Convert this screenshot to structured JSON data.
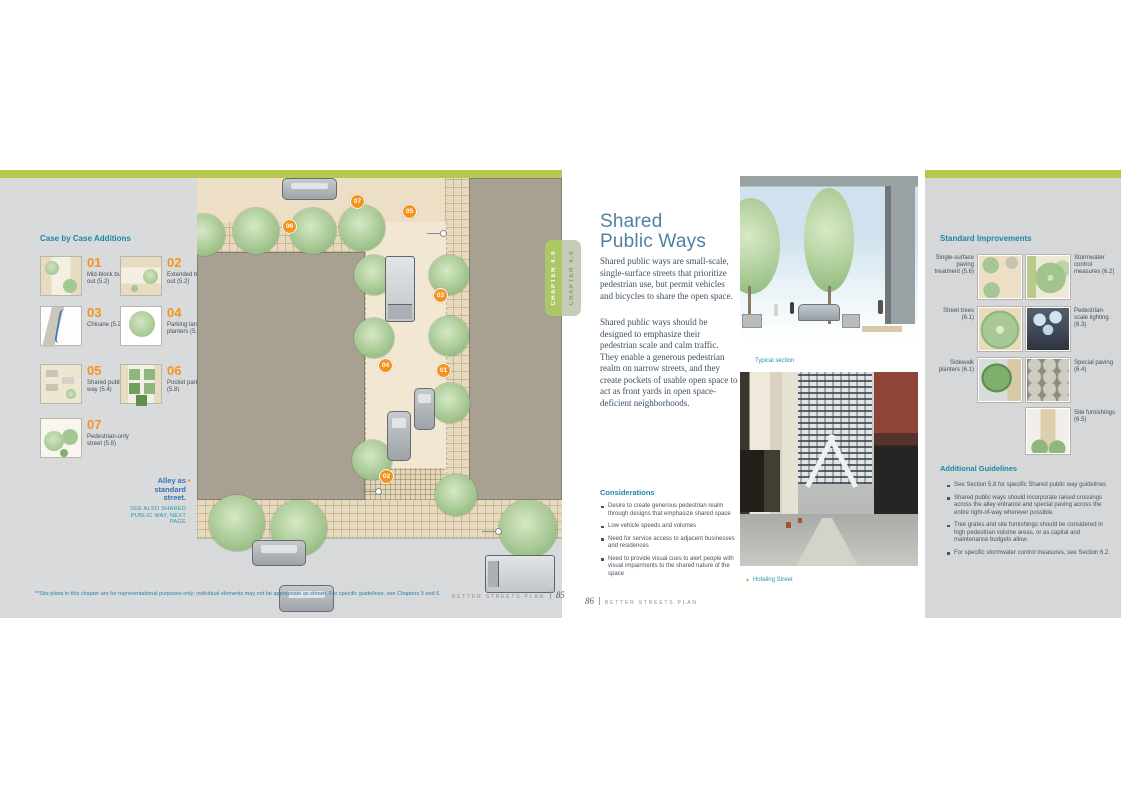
{
  "colors": {
    "accent_green": "#b3c84f",
    "teal_heading": "#1f87a3",
    "orange": "#f6921e",
    "link_blue": "#2f74b5"
  },
  "left_page": {
    "heading": "Case by Case Additions",
    "case_items": [
      {
        "num": "01",
        "label": "Mid-block bulb-out (5.2)"
      },
      {
        "num": "02",
        "label": "Extended bulb-out (5.2)"
      },
      {
        "num": "03",
        "label": "Chicane (5.2)"
      },
      {
        "num": "04",
        "label": "Parking lane planters (5.6)"
      },
      {
        "num": "05",
        "label": "Shared public way (5.4)"
      },
      {
        "num": "06",
        "label": "Pocket park (5.8)"
      },
      {
        "num": "07",
        "label": "Pedestrian-only street (5.8)"
      }
    ],
    "alley_callout_title": "Alley as standard street.",
    "alley_callout_note": "SEE ALSO SHARED PUBLIC WAY, NEXT PAGE",
    "plan_callouts": [
      "07",
      "05",
      "06",
      "03",
      "04",
      "01",
      "02"
    ],
    "footnote": "**Site plans in this chapter are for representational purposes only; individual elements may not be appropriate as shown. For specific guidelines, see Chapters 5 and 6.",
    "footer_book": "BETTER STREETS PLAN",
    "footer_page": "85"
  },
  "chapter_tab": {
    "front": "CHAPTER 4.0",
    "back": "CHAPTER 4.0"
  },
  "right_page": {
    "title_line1": "Shared",
    "title_line2": "Public Ways",
    "intro_p1": "Shared public ways are small-scale, single-surface streets that prioritize pedestrian use, but permit vehicles and bicycles to share the open space.",
    "intro_p2": "Shared public ways should be designed to emphasize their pedestrian scale and calm traffic. They enable a generous pedestrian realm on narrow streets, and they create pockets of usable open space to act as front yards in open space-deficient neighborhoods.",
    "considerations_heading": "Considerations",
    "considerations": [
      "Desire to create generous pedestrian realm through designs that emphasize shared space",
      "Low vehicle speeds and volumes",
      "Need for service access to adjacent businesses and residences",
      "Need to provide visual cues to alert people with visual impairments to the shared nature of the space"
    ],
    "typical_section_caption": "Typical section",
    "photo_caption": "Hotaling Street",
    "footer_page": "86",
    "footer_book": "BETTER STREETS PLAN",
    "improvements_heading": "Standard Improvements",
    "improvements": [
      {
        "label": "Single-surface paving treatment (5.6)"
      },
      {
        "label": "Stormwater control measures (6.2)"
      },
      {
        "label": "Street trees (6.1)"
      },
      {
        "label": "Pedestrian-scale lighting (6.3)"
      },
      {
        "label": "Sidewalk planters (6.1)"
      },
      {
        "label": "Special paving (6.4)"
      },
      {
        "label": "Site furnishings (6.5)"
      }
    ],
    "guidelines_heading": "Additional Guidelines",
    "guidelines": [
      "See Section 5.8 for specific Shared public way guidelines",
      "Shared public ways should incorporate raised crossings across the alley entrance and special paving across the entire right-of-way wherever possible.",
      "Tree grates and site furnishings should be considered in high pedestrian volume areas, or as capital and maintenance budgets allow.",
      "For specific stormwater control measures, see Section 6.2."
    ]
  }
}
